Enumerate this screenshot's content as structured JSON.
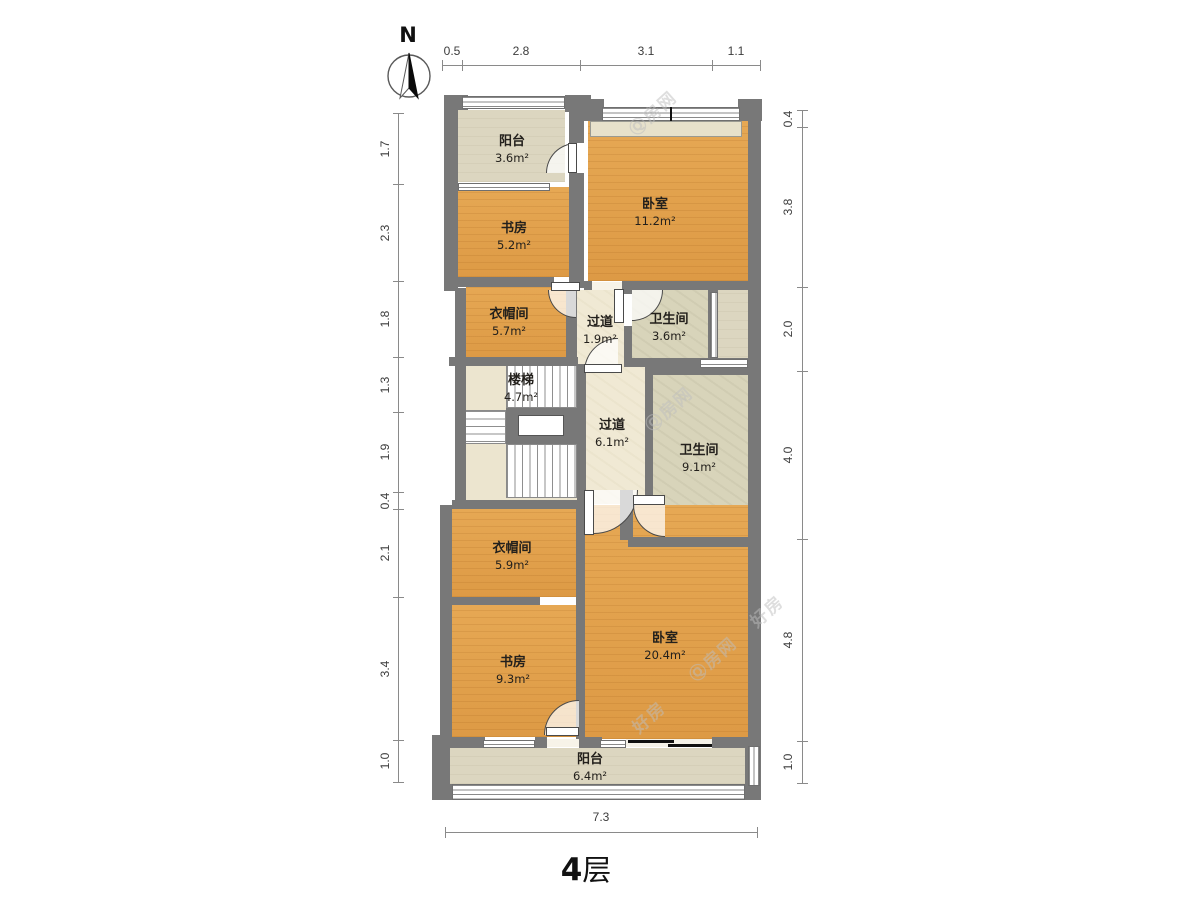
{
  "floor_label": {
    "number": "4",
    "suffix": "层"
  },
  "compass": {
    "label": "N"
  },
  "palette": {
    "wall": "#787878",
    "room_orange": "#e1a050",
    "room_beige": "#dcd6c0",
    "room_cream": "#f0e9d4",
    "room_bath": "#d8d4ba",
    "dim_text": "#3c3c3c"
  },
  "watermarks": [
    {
      "x": 652,
      "y": 112,
      "text": "Ⓠ房网"
    },
    {
      "x": 668,
      "y": 408,
      "text": "Ⓠ房网"
    },
    {
      "x": 712,
      "y": 658,
      "text": "Ⓠ房网"
    },
    {
      "x": 648,
      "y": 716,
      "text": "好房"
    },
    {
      "x": 766,
      "y": 610,
      "text": "好房"
    }
  ],
  "rooms": [
    {
      "id": "balcony-north",
      "name": "阳台",
      "area": "3.6m²",
      "type": "beige",
      "x": 458,
      "y": 110,
      "w": 107,
      "h": 72,
      "lx": 512,
      "ly": 150
    },
    {
      "id": "study-north",
      "name": "书房",
      "area": "5.2m²",
      "type": "orange",
      "x": 458,
      "y": 187,
      "w": 111,
      "h": 90,
      "lx": 514,
      "ly": 237
    },
    {
      "id": "bedroom-north",
      "name": "卧室",
      "area": "11.2m²",
      "type": "orange",
      "x": 588,
      "y": 121,
      "w": 160,
      "h": 160,
      "lx": 655,
      "ly": 213
    },
    {
      "id": "closet-north",
      "name": "衣帽间",
      "area": "5.7m²",
      "type": "orange",
      "x": 466,
      "y": 286,
      "w": 100,
      "h": 72,
      "lx": 509,
      "ly": 323
    },
    {
      "id": "hall-small",
      "name": "过道",
      "area": "1.9m²",
      "type": "cream",
      "x": 577,
      "y": 290,
      "w": 47,
      "h": 76,
      "lx": 600,
      "ly": 331
    },
    {
      "id": "bath-small",
      "name": "卫生间",
      "area": "3.6m²",
      "type": "bath",
      "x": 632,
      "y": 290,
      "w": 76,
      "h": 68,
      "lx": 669,
      "ly": 328
    },
    {
      "id": "duct-strip",
      "name": "",
      "area": "",
      "type": "beige",
      "x": 718,
      "y": 286,
      "w": 30,
      "h": 80,
      "lx": -100,
      "ly": -100
    },
    {
      "id": "hall-main",
      "name": "过道",
      "area": "6.1m²",
      "type": "cream",
      "x": 586,
      "y": 364,
      "w": 59,
      "h": 140,
      "lx": 612,
      "ly": 434
    },
    {
      "id": "bath-main",
      "name": "卫生间",
      "area": "9.1m²",
      "type": "bath",
      "x": 653,
      "y": 375,
      "w": 95,
      "h": 162,
      "lx": 699,
      "ly": 459
    },
    {
      "id": "bedroom-south",
      "name": "卧室",
      "area": "20.4m²",
      "type": "orange",
      "x": 582,
      "y": 505,
      "w": 166,
      "h": 234,
      "lx": 665,
      "ly": 647
    },
    {
      "id": "closet-south",
      "name": "衣帽间",
      "area": "5.9m²",
      "type": "orange",
      "x": 452,
      "y": 509,
      "w": 124,
      "h": 88,
      "lx": 512,
      "ly": 557
    },
    {
      "id": "study-south",
      "name": "书房",
      "area": "9.3m²",
      "type": "orange",
      "x": 452,
      "y": 605,
      "w": 124,
      "h": 132,
      "lx": 513,
      "ly": 671
    },
    {
      "id": "balcony-south",
      "name": "阳台",
      "area": "6.4m²",
      "type": "beige",
      "x": 450,
      "y": 748,
      "w": 295,
      "h": 36,
      "lx": 590,
      "ly": 768
    }
  ],
  "stairs": {
    "id": "stairs",
    "name": "楼梯",
    "area": "4.7m²",
    "lx": 521,
    "ly": 389,
    "floor": [
      466,
      366,
      111,
      134
    ],
    "flights": [
      {
        "x": 506,
        "y": 364,
        "w": 71,
        "h": 44,
        "dir": "v"
      },
      {
        "x": 462,
        "y": 410,
        "w": 44,
        "h": 34,
        "dir": "h"
      },
      {
        "x": 506,
        "y": 444,
        "w": 71,
        "h": 54,
        "dir": "v"
      }
    ],
    "landing_frame": [
      506,
      408,
      71,
      36
    ],
    "landing_inner": [
      518,
      415,
      46,
      21
    ]
  },
  "walls": [
    [
      444,
      95,
      14,
      196
    ],
    [
      455,
      288,
      11,
      214
    ],
    [
      440,
      505,
      12,
      235
    ],
    [
      432,
      735,
      18,
      62
    ],
    [
      444,
      95,
      24,
      15
    ],
    [
      565,
      95,
      26,
      17
    ],
    [
      584,
      99,
      20,
      22
    ],
    [
      738,
      99,
      24,
      22
    ],
    [
      748,
      99,
      13,
      651
    ],
    [
      450,
      737,
      35,
      11
    ],
    [
      535,
      737,
      12,
      11
    ],
    [
      579,
      737,
      23,
      11
    ],
    [
      712,
      737,
      37,
      11
    ],
    [
      745,
      742,
      16,
      48
    ],
    [
      432,
      784,
      20,
      16
    ],
    [
      745,
      784,
      16,
      16
    ],
    [
      569,
      95,
      15,
      48
    ],
    [
      569,
      173,
      15,
      115
    ],
    [
      566,
      286,
      11,
      80
    ],
    [
      577,
      364,
      9,
      140
    ],
    [
      576,
      504,
      9,
      241
    ],
    [
      624,
      286,
      8,
      8
    ],
    [
      624,
      326,
      8,
      40
    ],
    [
      708,
      286,
      10,
      80
    ],
    [
      452,
      277,
      102,
      10
    ],
    [
      584,
      281,
      8,
      9
    ],
    [
      622,
      281,
      126,
      9
    ],
    [
      449,
      357,
      129,
      9
    ],
    [
      624,
      358,
      124,
      9
    ],
    [
      645,
      366,
      8,
      129
    ],
    [
      645,
      366,
      103,
      9
    ],
    [
      628,
      537,
      120,
      10
    ],
    [
      620,
      490,
      13,
      50
    ],
    [
      452,
      500,
      126,
      9
    ],
    [
      452,
      597,
      88,
      8
    ]
  ],
  "windows": [
    {
      "x": 462,
      "y": 96,
      "w": 103,
      "h": 13,
      "style": "multi-h"
    },
    {
      "x": 602,
      "y": 107,
      "w": 138,
      "h": 14,
      "style": "multi-h"
    },
    {
      "x": 458,
      "y": 183,
      "w": 92,
      "h": 8,
      "style": "h2"
    },
    {
      "x": 700,
      "y": 359,
      "w": 48,
      "h": 9,
      "style": "h2"
    },
    {
      "x": 710,
      "y": 292,
      "w": 8,
      "h": 66,
      "style": "multi-v"
    },
    {
      "x": 483,
      "y": 740,
      "w": 52,
      "h": 8,
      "style": "h2"
    },
    {
      "x": 600,
      "y": 740,
      "w": 26,
      "h": 8,
      "style": "h2"
    },
    {
      "x": 452,
      "y": 784,
      "w": 293,
      "h": 16,
      "style": "multi-h"
    },
    {
      "x": 748,
      "y": 746,
      "w": 12,
      "h": 40,
      "style": "multi-v"
    }
  ],
  "sills": [
    {
      "x": 590,
      "y": 121,
      "w": 152,
      "h": 16
    }
  ],
  "black_ticks": [
    {
      "x": 670,
      "y": 107,
      "w": 2,
      "h": 14
    }
  ],
  "thresholds": [
    {
      "x": 592,
      "y": 282,
      "w": 30,
      "h": 8
    },
    {
      "x": 547,
      "y": 739,
      "w": 32,
      "h": 8
    }
  ],
  "doors": [
    {
      "id": "door-balcony-north",
      "x": 546,
      "y": 143,
      "r": 30,
      "corner": "tl",
      "leaf": {
        "x": 568,
        "y": 143,
        "w": 9,
        "h": 30
      }
    },
    {
      "id": "door-closet-north",
      "x": 548,
      "y": 290,
      "r": 28,
      "corner": "bl",
      "leaf": {
        "x": 551,
        "y": 282,
        "w": 29,
        "h": 9
      }
    },
    {
      "id": "door-hall-small",
      "x": 584,
      "y": 338,
      "r": 34,
      "corner": "tl",
      "leaf": {
        "x": 584,
        "y": 364,
        "w": 38,
        "h": 9
      }
    },
    {
      "id": "door-bath-small",
      "x": 632,
      "y": 290,
      "r": 31,
      "corner": "br",
      "leaf": {
        "x": 614,
        "y": 289,
        "w": 10,
        "h": 34
      }
    },
    {
      "id": "door-bedroom-south",
      "x": 594,
      "y": 490,
      "r": 44,
      "corner": "br",
      "leaf": {
        "x": 584,
        "y": 490,
        "w": 10,
        "h": 45
      }
    },
    {
      "id": "door-bath-main",
      "x": 633,
      "y": 505,
      "r": 32,
      "corner": "bl",
      "leaf": {
        "x": 633,
        "y": 495,
        "w": 32,
        "h": 10
      }
    },
    {
      "id": "door-study-south",
      "x": 544,
      "y": 700,
      "r": 35,
      "corner": "tl",
      "leaf": {
        "x": 546,
        "y": 727,
        "w": 33,
        "h": 9
      }
    }
  ],
  "slider": {
    "bg": {
      "x": 626,
      "y": 739,
      "w": 86,
      "h": 8
    },
    "bars": [
      {
        "x": 628,
        "y": 740,
        "w": 46,
        "h": 3
      },
      {
        "x": 668,
        "y": 744,
        "w": 44,
        "h": 3
      }
    ]
  },
  "dimensions": [
    {
      "orient": "h",
      "pos": 65,
      "label_off": -14,
      "segs": [
        {
          "a": 442,
          "b": 462,
          "t": "0.5"
        },
        {
          "a": 462,
          "b": 580,
          "t": "2.8"
        },
        {
          "a": 580,
          "b": 712,
          "t": "3.1"
        },
        {
          "a": 712,
          "b": 760,
          "t": "1.1"
        }
      ]
    },
    {
      "orient": "v",
      "pos": 398,
      "label_off": -13,
      "segs": [
        {
          "a": 113,
          "b": 184,
          "t": "1.7"
        },
        {
          "a": 184,
          "b": 281,
          "t": "2.3"
        },
        {
          "a": 281,
          "b": 357,
          "t": "1.8"
        },
        {
          "a": 357,
          "b": 412,
          "t": "1.3"
        },
        {
          "a": 412,
          "b": 492,
          "t": "1.9"
        },
        {
          "a": 492,
          "b": 509,
          "t": "0.4"
        },
        {
          "a": 509,
          "b": 597,
          "t": "2.1"
        },
        {
          "a": 597,
          "b": 740,
          "t": "3.4"
        },
        {
          "a": 740,
          "b": 782,
          "t": "1.0"
        }
      ]
    },
    {
      "orient": "v",
      "pos": 802,
      "label_off": -14,
      "segs": [
        {
          "a": 110,
          "b": 127,
          "t": "0.4"
        },
        {
          "a": 127,
          "b": 287,
          "t": "3.8"
        },
        {
          "a": 287,
          "b": 371,
          "t": "2.0"
        },
        {
          "a": 371,
          "b": 539,
          "t": "4.0"
        },
        {
          "a": 539,
          "b": 741,
          "t": "4.8"
        },
        {
          "a": 741,
          "b": 783,
          "t": "1.0"
        }
      ]
    },
    {
      "orient": "h",
      "pos": 832,
      "label_off": -15,
      "segs": [
        {
          "a": 445,
          "b": 757,
          "t": "7.3"
        }
      ]
    }
  ]
}
